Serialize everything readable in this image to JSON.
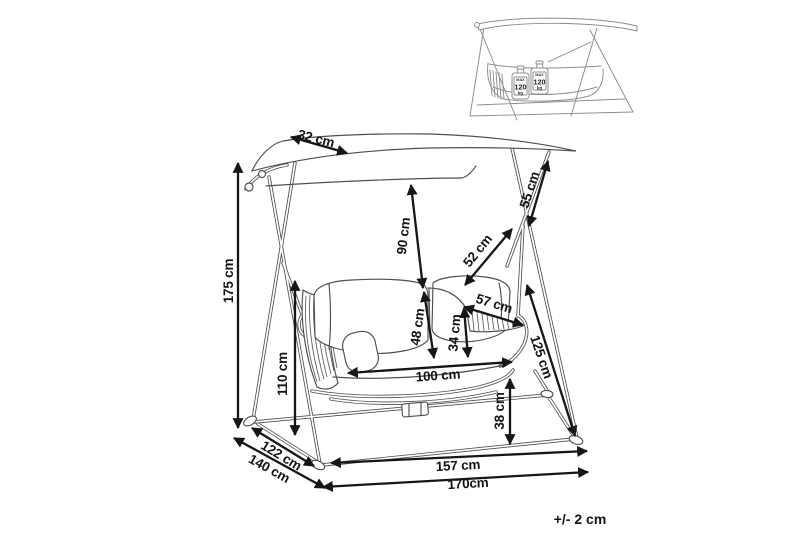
{
  "dimensions": {
    "canopy_depth": "32 cm",
    "overall_height": "175 cm",
    "pivot_height": "110 cm",
    "depth_inner": "122 cm",
    "depth_overall": "140 cm",
    "canopy_to_seat": "90 cm",
    "backrest_height": "48 cm",
    "side_panel_height": "34 cm",
    "seat_width": "100 cm",
    "hanger_length": "52 cm",
    "side_panel_width": "57 cm",
    "upper_strut": "55 cm",
    "leg_length": "125 cm",
    "seat_clearance": "38 cm",
    "base_width_inner": "157 cm",
    "base_width_overall": "170cm"
  },
  "tolerance": "+/- 2 cm",
  "inset": {
    "weight": {
      "prefix": "MAX",
      "value": "120",
      "unit": "kg"
    }
  }
}
